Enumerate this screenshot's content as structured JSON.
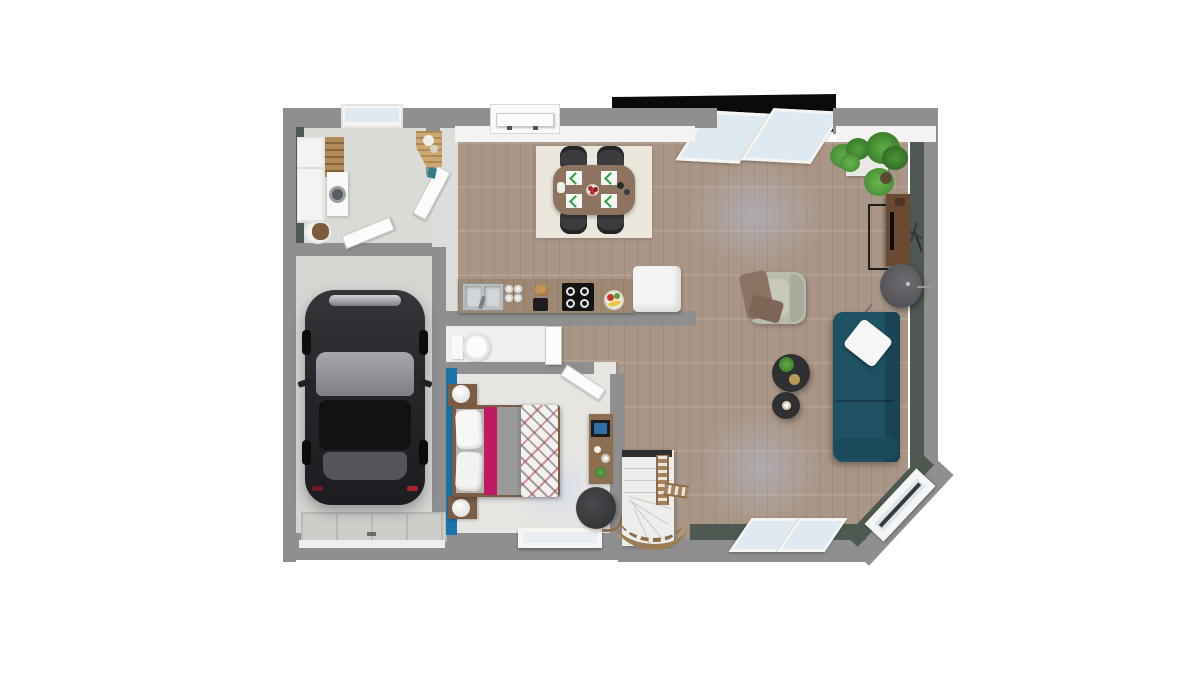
{
  "scene": {
    "type": "3d-floor-plan-top-view-render",
    "background": "#ffffff",
    "storey": "ground-floor"
  },
  "palette": {
    "wall_top": "#8f8f8f",
    "wall_face_white": "#f3f3f1",
    "wall_dark_green": "#4e5952",
    "accent_blue_wall": "#1b74a9",
    "wood_floor": "#b09b8a",
    "laundry_floor": "#dadad7",
    "hall_floor": "#dddddc",
    "garage_floor": "#d5d5d2",
    "bedroom_floor": "#e6e5e2",
    "wc_floor": "#eef0ed",
    "rug_cream": "#ece7dc",
    "dining_table_wood": "#8d7461",
    "chair_dark": "#3c3c3e",
    "kitchen_counter_wood": "#9e8874",
    "fridge_white": "#f4f4f2",
    "cooktop_black": "#141414",
    "sofa_teal": "#1f5164",
    "armchair_sage": "#b9bcad",
    "throw_brown": "#8b7263",
    "coffee_table_black": "#303033",
    "tv_console_wood": "#6b4a33",
    "plant_green": "#4c8f3a",
    "bed_frame_wood": "#7b5d45",
    "bed_magenta": "#c01a62",
    "bed_gray_duvet": "#9a9a98",
    "car_black": "#26262a",
    "garage_door_gray": "#cdcdca",
    "stair_white": "#ededeb",
    "stair_rail_wood": "#9c7c55",
    "glass_blue": "#dfe9f2",
    "porch_dark": "#0b0b0b"
  },
  "rooms": [
    {
      "name": "utility-room",
      "furniture": [
        "storage-cabinets",
        "ladder-shelf",
        "washing-machine",
        "corner-coat-unit",
        "pet-bed",
        "teal-bin"
      ]
    },
    {
      "name": "entry-hall",
      "furniture": [
        "front-door",
        "open-door-to-utility",
        "open-door-to-garage"
      ]
    },
    {
      "name": "garage",
      "furniture": [
        "black-car",
        "sectional-garage-door"
      ]
    },
    {
      "name": "kitchen",
      "furniture": [
        "double-sink",
        "glass-set",
        "bread-loaf",
        "coffee-maker",
        "four-burner-cooktop",
        "fruit-bowl",
        "refrigerator"
      ]
    },
    {
      "name": "dining-area",
      "furniture": [
        "cream-rug",
        "wood-dining-table",
        "four-dark-chairs",
        "four-place-settings",
        "flower-centerpiece",
        "bottle-set",
        "white-jug"
      ]
    },
    {
      "name": "living-room",
      "furniture": [
        "teal-sofa",
        "white-cushion",
        "sage-armchair",
        "brown-throw",
        "round-coffee-table-large",
        "round-coffee-table-small",
        "tv-console",
        "floor-lamp",
        "potted-plants",
        "branch-wall-decor"
      ]
    },
    {
      "name": "wc",
      "furniture": [
        "toilet",
        "wc-door"
      ]
    },
    {
      "name": "bedroom",
      "furniture": [
        "double-bed",
        "patterned-duvet",
        "magenta-runner",
        "two-nightstands",
        "two-sphere-lamps",
        "desk-with-monitor",
        "office-chair",
        "open-door"
      ]
    },
    {
      "name": "staircase",
      "furniture": [
        "winder-stairs",
        "wood-handrail",
        "curved-wood-balustrade"
      ]
    }
  ],
  "openings": [
    "utility-window-top",
    "front-entry-door",
    "porch-awning-windows",
    "patio-sliding-windows",
    "chamfer-corner-window",
    "bedroom-window",
    "garage-door"
  ]
}
